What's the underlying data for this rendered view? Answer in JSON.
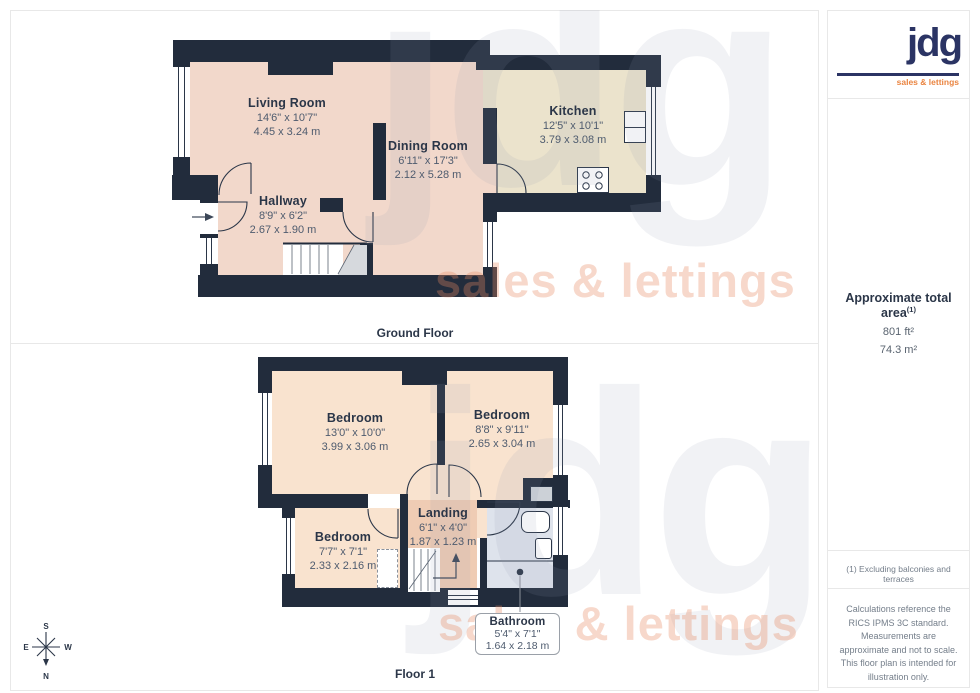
{
  "branding": {
    "logo_text": "jdg",
    "logo_tagline": "sales & lettings",
    "watermark_text": "jdg",
    "watermark_tagline": "sales & lettings"
  },
  "sidebar": {
    "area_title": "Approximate total area",
    "area_superscript": "(1)",
    "area_ft": "801 ft²",
    "area_m": "74.3 m²",
    "footnote": "(1) Excluding balconies and terraces",
    "disclaimer": "Calculations reference the RICS IPMS 3C standard. Measurements are approximate and not to scale. This floor plan is intended for illustration only.",
    "brand_word": "GIRAFFE",
    "brand_number": "360"
  },
  "ground_floor": {
    "caption": "Ground Floor",
    "rooms": [
      {
        "name": "Living Room",
        "dims_ft": "14'6\" x 10'7\"",
        "dims_m": "4.45 x 3.24 m"
      },
      {
        "name": "Dining Room",
        "dims_ft": "6'11\" x 17'3\"",
        "dims_m": "2.12 x 5.28 m"
      },
      {
        "name": "Hallway",
        "dims_ft": "8'9\" x 6'2\"",
        "dims_m": "2.67 x 1.90 m"
      },
      {
        "name": "Kitchen",
        "dims_ft": "12'5\" x 10'1\"",
        "dims_m": "3.79 x 3.08 m"
      }
    ]
  },
  "floor1": {
    "caption": "Floor 1",
    "rooms": [
      {
        "name": "Bedroom",
        "dims_ft": "13'0\" x 10'0\"",
        "dims_m": "3.99 x 3.06 m"
      },
      {
        "name": "Bedroom",
        "dims_ft": "8'8\" x 9'11\"",
        "dims_m": "2.65 x 3.04 m"
      },
      {
        "name": "Bedroom",
        "dims_ft": "7'7\" x 7'1\"",
        "dims_m": "2.33 x 2.16 m"
      },
      {
        "name": "Landing",
        "dims_ft": "6'1\" x 4'0\"",
        "dims_m": "1.87 x 1.23 m"
      },
      {
        "name": "Bathroom",
        "dims_ft": "5'4\" x 7'1\"",
        "dims_m": "1.64 x 2.18 m"
      }
    ]
  },
  "compass": {
    "n": "N",
    "s": "S",
    "e": "E",
    "w": "W"
  },
  "colors": {
    "wall": "#222c3c",
    "room_pink": "#f2d8cb",
    "room_peach": "#f9e3cf",
    "landing": "#efccb4",
    "kitchen": "#ebe3cc",
    "bathroom": "#dee3ec",
    "stairs_gray": "#d6d9dd",
    "logo_navy": "#2b3464",
    "logo_orange": "#ea8440",
    "label_navy": "#2b3648"
  }
}
